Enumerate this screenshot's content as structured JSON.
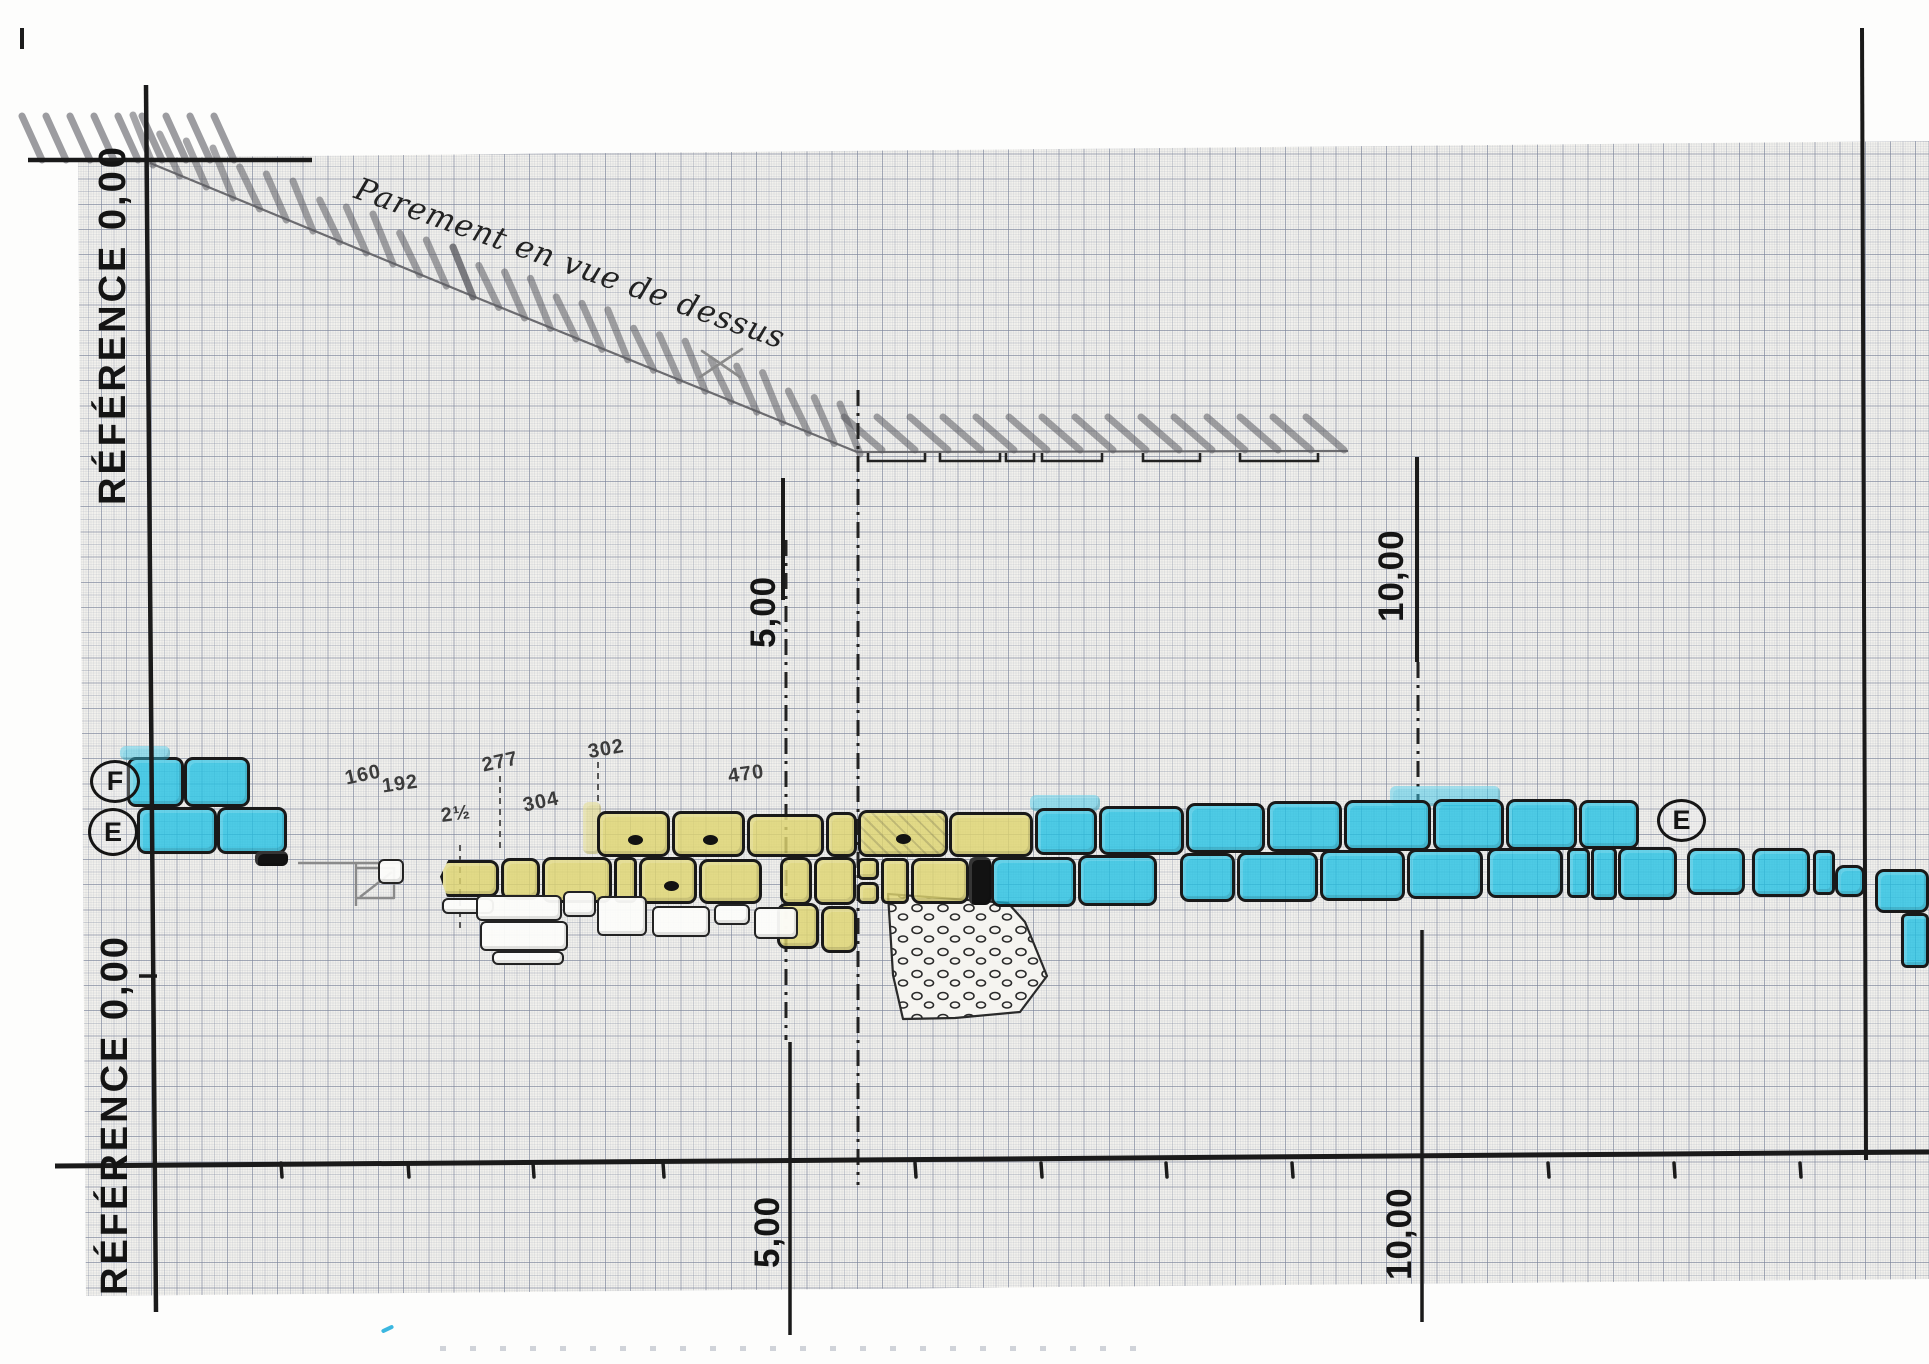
{
  "drawing_title": "Parement en vue de dessus",
  "reference_label": "RÉFÉRENCE 0,00",
  "axis": {
    "top_tick_5": "5,00",
    "top_tick_10": "10,00",
    "bottom_tick_5": "5,00",
    "bottom_tick_10": "10,00"
  },
  "markers": {
    "left_top": "F",
    "left_middle": "E",
    "right": "E"
  },
  "stone_annotations": [
    {
      "text": "160",
      "x": 345,
      "y": 764,
      "rot": -12
    },
    {
      "text": "192",
      "x": 382,
      "y": 773,
      "rot": -8
    },
    {
      "text": "277",
      "x": 482,
      "y": 751,
      "rot": -12
    },
    {
      "text": "302",
      "x": 588,
      "y": 738,
      "rot": -10
    },
    {
      "text": "2½",
      "x": 441,
      "y": 803,
      "rot": -8
    },
    {
      "text": "304",
      "x": 523,
      "y": 791,
      "rot": -12
    },
    {
      "text": "470",
      "x": 728,
      "y": 763,
      "rot": -8
    }
  ],
  "colors": {
    "stone_blue": "#20c0e3",
    "stone_yellow": "#ded46e",
    "ink": "#1a1a1a",
    "pencil": "#8a8a8a",
    "grid_line": "#7a8298",
    "paper": "#f2f1ed"
  },
  "figure": {
    "ink": [
      [
        28,
        160,
        312,
        160,
        4.5
      ],
      [
        146,
        85,
        156,
        1312,
        4.5
      ],
      [
        55,
        1166,
        1929,
        1152,
        5
      ],
      [
        1862,
        28,
        1866,
        1160,
        4
      ],
      [
        783,
        478,
        783,
        600,
        4
      ],
      [
        1417,
        457,
        1417,
        662,
        4
      ],
      [
        790,
        1042,
        790,
        1335,
        3.5
      ],
      [
        1422,
        930,
        1422,
        1322,
        3.5
      ],
      [
        139,
        976,
        157,
        976,
        3.5
      ]
    ],
    "ticks": {
      "y": 1163,
      "h": 14,
      "xs": [
        281,
        408,
        533,
        663,
        915,
        1041,
        1166,
        1292,
        1548,
        1674,
        1800
      ]
    },
    "dashdot": [
      [
        858,
        390,
        858,
        1185
      ],
      [
        786,
        540,
        786,
        1040
      ],
      [
        1418,
        662,
        1418,
        800
      ]
    ],
    "dashed": [
      [
        500,
        776,
        500,
        848
      ],
      [
        598,
        762,
        598,
        806
      ],
      [
        460,
        845,
        460,
        928
      ]
    ],
    "slope": [
      [
        150,
        163
      ],
      [
        470,
        295
      ],
      [
        857,
        452
      ]
    ],
    "strip_line": [
      [
        857,
        452
      ],
      [
        1348,
        451
      ]
    ],
    "slope_hatch": {
      "step": 27,
      "dx1": -17,
      "dy1": -48,
      "dx2": 3,
      "dy2": 2
    },
    "strip_hatch": {
      "x0": 878,
      "x1": 1345,
      "step": 33,
      "ytop": 411,
      "ybot": 450
    },
    "margin_hatch": {
      "x0": 38,
      "x1": 250,
      "step": 24,
      "ytop": 112,
      "ybot": 160
    },
    "brackets": [
      [
        868,
        925
      ],
      [
        940,
        1000
      ],
      [
        1006,
        1034
      ],
      [
        1042,
        1102
      ],
      [
        1143,
        1200
      ],
      [
        1240,
        1318
      ]
    ],
    "x_mark": [
      [
        700,
        377,
        742,
        349
      ],
      [
        702,
        351,
        740,
        377
      ]
    ],
    "pencil": [
      [
        [
          298,
          863
        ],
        [
          400,
          863
        ]
      ],
      [
        [
          356,
          863
        ],
        [
          356,
          906
        ]
      ],
      [
        [
          356,
          868
        ],
        [
          394,
          868
        ],
        [
          394,
          898
        ],
        [
          356,
          898
        ]
      ],
      [
        [
          360,
          897
        ],
        [
          392,
          872
        ]
      ]
    ],
    "rubble": [
      [
        888,
        894
      ],
      [
        1008,
        903
      ],
      [
        1025,
        922
      ],
      [
        1047,
        976
      ],
      [
        1020,
        1012
      ],
      [
        955,
        1018
      ],
      [
        903,
        1019
      ],
      [
        893,
        975
      ]
    ],
    "stones": [
      {
        "x": 127,
        "y": 757,
        "w": 57,
        "h": 50,
        "c": "b"
      },
      {
        "x": 184,
        "y": 757,
        "w": 66,
        "h": 50,
        "c": "b"
      },
      {
        "x": 137,
        "y": 807,
        "w": 80,
        "h": 47,
        "c": "b"
      },
      {
        "x": 217,
        "y": 807,
        "w": 70,
        "h": 47,
        "c": "b"
      },
      {
        "x": 255,
        "y": 851,
        "w": 33,
        "h": 15,
        "c": "k"
      },
      {
        "x": 120,
        "y": 746,
        "w": 50,
        "h": 14,
        "c": "bg"
      },
      {
        "x": 583,
        "y": 802,
        "w": 18,
        "h": 52,
        "c": "yg"
      },
      {
        "x": 1030,
        "y": 795,
        "w": 70,
        "h": 16,
        "c": "bg"
      },
      {
        "x": 1390,
        "y": 786,
        "w": 110,
        "h": 20,
        "c": "bg"
      },
      {
        "x": 597,
        "y": 811,
        "w": 73,
        "h": 46,
        "c": "y",
        "d": 1
      },
      {
        "x": 672,
        "y": 811,
        "w": 73,
        "h": 46,
        "c": "y",
        "d": 1
      },
      {
        "x": 747,
        "y": 814,
        "w": 77,
        "h": 43,
        "c": "y"
      },
      {
        "x": 826,
        "y": 812,
        "w": 31,
        "h": 45,
        "c": "y"
      },
      {
        "x": 858,
        "y": 810,
        "w": 90,
        "h": 47,
        "c": "y",
        "d": 1,
        "ht": 1
      },
      {
        "x": 949,
        "y": 812,
        "w": 84,
        "h": 45,
        "c": "y"
      },
      {
        "x": 1035,
        "y": 808,
        "w": 62,
        "h": 47,
        "c": "b"
      },
      {
        "x": 1099,
        "y": 806,
        "w": 85,
        "h": 49,
        "c": "b"
      },
      {
        "x": 1186,
        "y": 803,
        "w": 79,
        "h": 50,
        "c": "b"
      },
      {
        "x": 1267,
        "y": 801,
        "w": 75,
        "h": 51,
        "c": "b"
      },
      {
        "x": 1344,
        "y": 800,
        "w": 87,
        "h": 51,
        "c": "b"
      },
      {
        "x": 1433,
        "y": 799,
        "w": 71,
        "h": 52,
        "c": "b"
      },
      {
        "x": 1506,
        "y": 799,
        "w": 71,
        "h": 51,
        "c": "b"
      },
      {
        "x": 1579,
        "y": 800,
        "w": 60,
        "h": 49,
        "c": "b"
      },
      {
        "x": 440,
        "y": 860,
        "w": 59,
        "h": 37,
        "c": "y",
        "t": 1
      },
      {
        "x": 501,
        "y": 858,
        "w": 39,
        "h": 42,
        "c": "y"
      },
      {
        "x": 542,
        "y": 857,
        "w": 70,
        "h": 46,
        "c": "y"
      },
      {
        "x": 614,
        "y": 857,
        "w": 23,
        "h": 46,
        "c": "y"
      },
      {
        "x": 639,
        "y": 857,
        "w": 58,
        "h": 47,
        "c": "y",
        "d": 1
      },
      {
        "x": 699,
        "y": 859,
        "w": 63,
        "h": 45,
        "c": "y"
      },
      {
        "x": 780,
        "y": 857,
        "w": 32,
        "h": 48,
        "c": "y"
      },
      {
        "x": 814,
        "y": 857,
        "w": 42,
        "h": 48,
        "c": "y"
      },
      {
        "x": 857,
        "y": 858,
        "w": 22,
        "h": 22,
        "c": "y"
      },
      {
        "x": 857,
        "y": 882,
        "w": 22,
        "h": 22,
        "c": "y"
      },
      {
        "x": 881,
        "y": 858,
        "w": 28,
        "h": 46,
        "c": "y"
      },
      {
        "x": 911,
        "y": 858,
        "w": 58,
        "h": 46,
        "c": "y"
      },
      {
        "x": 969,
        "y": 857,
        "w": 22,
        "h": 48,
        "c": "k"
      },
      {
        "x": 991,
        "y": 857,
        "w": 85,
        "h": 50,
        "c": "b"
      },
      {
        "x": 1078,
        "y": 855,
        "w": 79,
        "h": 51,
        "c": "b"
      },
      {
        "x": 1180,
        "y": 853,
        "w": 55,
        "h": 49,
        "c": "b"
      },
      {
        "x": 1237,
        "y": 852,
        "w": 81,
        "h": 50,
        "c": "b"
      },
      {
        "x": 1320,
        "y": 850,
        "w": 85,
        "h": 51,
        "c": "b"
      },
      {
        "x": 1407,
        "y": 849,
        "w": 76,
        "h": 50,
        "c": "b"
      },
      {
        "x": 1487,
        "y": 848,
        "w": 76,
        "h": 50,
        "c": "b"
      },
      {
        "x": 1567,
        "y": 848,
        "w": 23,
        "h": 50,
        "c": "b"
      },
      {
        "x": 1591,
        "y": 847,
        "w": 26,
        "h": 53,
        "c": "b"
      },
      {
        "x": 1618,
        "y": 847,
        "w": 59,
        "h": 53,
        "c": "b"
      },
      {
        "x": 1687,
        "y": 848,
        "w": 58,
        "h": 47,
        "c": "b"
      },
      {
        "x": 1752,
        "y": 848,
        "w": 58,
        "h": 49,
        "c": "b"
      },
      {
        "x": 1813,
        "y": 850,
        "w": 22,
        "h": 45,
        "c": "b"
      },
      {
        "x": 1835,
        "y": 865,
        "w": 30,
        "h": 32,
        "c": "b"
      },
      {
        "x": 1875,
        "y": 869,
        "w": 54,
        "h": 44,
        "c": "b"
      },
      {
        "x": 1901,
        "y": 913,
        "w": 28,
        "h": 55,
        "c": "b"
      },
      {
        "x": 777,
        "y": 903,
        "w": 42,
        "h": 46,
        "c": "y"
      },
      {
        "x": 821,
        "y": 906,
        "w": 36,
        "h": 47,
        "c": "y"
      },
      {
        "x": 378,
        "y": 859,
        "w": 26,
        "h": 25,
        "c": "w"
      },
      {
        "x": 442,
        "y": 898,
        "w": 52,
        "h": 16,
        "c": "w"
      },
      {
        "x": 476,
        "y": 895,
        "w": 86,
        "h": 26,
        "c": "w"
      },
      {
        "x": 480,
        "y": 921,
        "w": 88,
        "h": 30,
        "c": "w"
      },
      {
        "x": 492,
        "y": 951,
        "w": 72,
        "h": 14,
        "c": "w"
      },
      {
        "x": 563,
        "y": 891,
        "w": 33,
        "h": 26,
        "c": "w"
      },
      {
        "x": 597,
        "y": 896,
        "w": 50,
        "h": 40,
        "c": "w"
      },
      {
        "x": 652,
        "y": 906,
        "w": 58,
        "h": 31,
        "c": "w"
      },
      {
        "x": 714,
        "y": 904,
        "w": 36,
        "h": 21,
        "c": "w"
      },
      {
        "x": 754,
        "y": 907,
        "w": 44,
        "h": 32,
        "c": "w"
      }
    ]
  }
}
